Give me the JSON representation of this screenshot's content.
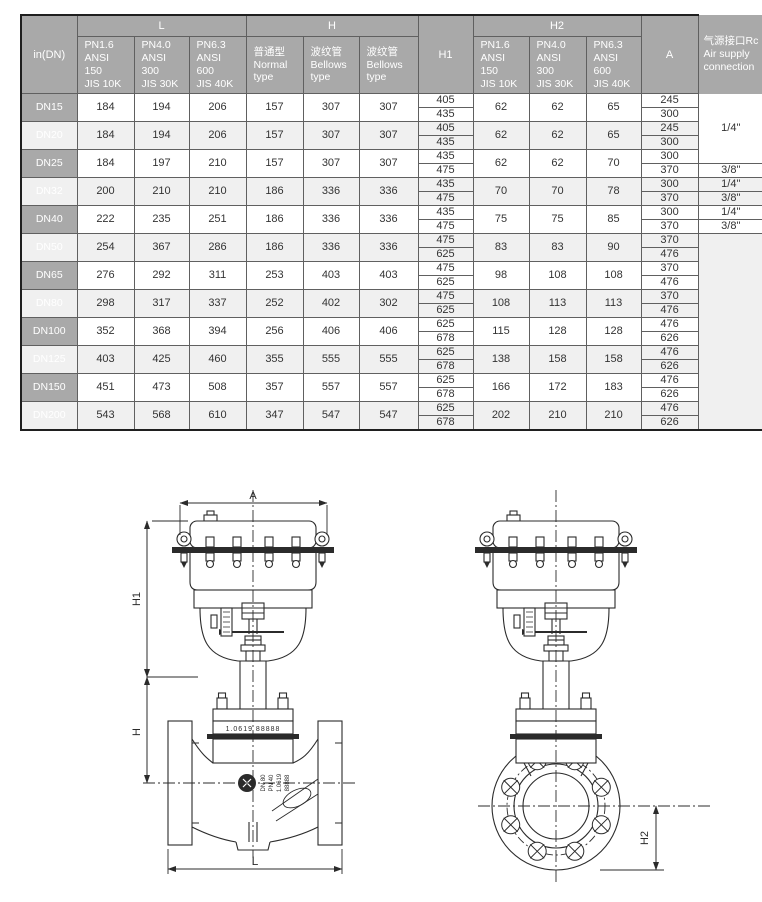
{
  "table": {
    "col_groups": {
      "dn": "in(DN)",
      "L": "L",
      "H": "H",
      "H1": "H1",
      "H2": "H2",
      "A": "A",
      "rc": "气源接口Rc\nAir supply\nconnection"
    },
    "sub_headers": {
      "L": [
        "PN1.6\nANSI\n150\nJIS 10K",
        "PN4.0\nANSI\n300\nJIS 30K",
        "PN6.3\nANSI\n600\nJIS 40K"
      ],
      "H": [
        "普通型\nNormal\ntype",
        "波纹管\nBellows\ntype",
        "波纹管\nBellows\ntype"
      ],
      "H2": [
        "PN1.6\nANSI\n150\nJIS 10K",
        "PN4.0\nANSI\n300\nJIS 30K",
        "PN6.3\nANSI\n600\nJIS 40K"
      ]
    },
    "rows": [
      {
        "dn": "DN15",
        "L": [
          184,
          194,
          206
        ],
        "H": [
          157,
          307,
          307
        ],
        "H1": [
          405,
          435
        ],
        "H2": [
          62,
          62,
          65
        ],
        "A": [
          245,
          300
        ]
      },
      {
        "dn": "DN20",
        "L": [
          184,
          194,
          206
        ],
        "H": [
          157,
          307,
          307
        ],
        "H1": [
          405,
          435
        ],
        "H2": [
          62,
          62,
          65
        ],
        "A": [
          245,
          300
        ]
      },
      {
        "dn": "DN25",
        "L": [
          184,
          197,
          210
        ],
        "H": [
          157,
          307,
          307
        ],
        "H1": [
          435,
          475
        ],
        "H2": [
          62,
          62,
          70
        ],
        "A": [
          300,
          370
        ]
      },
      {
        "dn": "DN32",
        "L": [
          200,
          210,
          210
        ],
        "H": [
          186,
          336,
          336
        ],
        "H1": [
          435,
          475
        ],
        "H2": [
          70,
          70,
          78
        ],
        "A": [
          300,
          370
        ]
      },
      {
        "dn": "DN40",
        "L": [
          222,
          235,
          251
        ],
        "H": [
          186,
          336,
          336
        ],
        "H1": [
          435,
          475
        ],
        "H2": [
          75,
          75,
          85
        ],
        "A": [
          300,
          370
        ]
      },
      {
        "dn": "DN50",
        "L": [
          254,
          367,
          286
        ],
        "H": [
          186,
          336,
          336
        ],
        "H1": [
          475,
          625
        ],
        "H2": [
          83,
          83,
          90
        ],
        "A": [
          370,
          476
        ]
      },
      {
        "dn": "DN65",
        "L": [
          276,
          292,
          311
        ],
        "H": [
          253,
          403,
          403
        ],
        "H1": [
          475,
          625
        ],
        "H2": [
          98,
          108,
          108
        ],
        "A": [
          370,
          476
        ]
      },
      {
        "dn": "DN80",
        "L": [
          298,
          317,
          337
        ],
        "H": [
          252,
          402,
          302
        ],
        "H1": [
          475,
          625
        ],
        "H2": [
          108,
          113,
          113
        ],
        "A": [
          370,
          476
        ]
      },
      {
        "dn": "DN100",
        "L": [
          352,
          368,
          394
        ],
        "H": [
          256,
          406,
          406
        ],
        "H1": [
          625,
          678
        ],
        "H2": [
          115,
          128,
          128
        ],
        "A": [
          476,
          626
        ]
      },
      {
        "dn": "DN125",
        "L": [
          403,
          425,
          460
        ],
        "H": [
          355,
          555,
          555
        ],
        "H1": [
          625,
          678
        ],
        "H2": [
          138,
          158,
          158
        ],
        "A": [
          476,
          626
        ]
      },
      {
        "dn": "DN150",
        "L": [
          451,
          473,
          508
        ],
        "H": [
          357,
          557,
          557
        ],
        "H1": [
          625,
          678
        ],
        "H2": [
          166,
          172,
          183
        ],
        "A": [
          476,
          626
        ]
      },
      {
        "dn": "DN200",
        "L": [
          543,
          568,
          610
        ],
        "H": [
          347,
          547,
          547
        ],
        "H1": [
          625,
          678
        ],
        "H2": [
          202,
          210,
          210
        ],
        "A": [
          476,
          626
        ]
      }
    ],
    "rc_spans": [
      {
        "label": "1/4\"",
        "span": 5
      },
      {
        "label": "3/8\"",
        "span": 1
      },
      {
        "label": "1/4\"",
        "span": 1
      },
      {
        "label": "3/8\"",
        "span": 1
      },
      {
        "label": "1/4\"",
        "span": 1
      },
      {
        "label": "3/8\"",
        "span": 1
      },
      {
        "label": "",
        "span": 14
      }
    ]
  },
  "drawings": {
    "dim_A": "A",
    "dim_H1": "H1",
    "dim_H": "H",
    "dim_L": "L",
    "dim_H2": "H2",
    "bonnet_plate": "1.0619 88888",
    "body_marking": [
      "DN 80",
      "PN 40",
      "1.0619",
      "88888"
    ]
  },
  "colors": {
    "header_bg": "#a9a9a9",
    "row_alt": "#f0f0f0",
    "grid_line": "#606060",
    "drawing_line": "#2b2b2b"
  }
}
